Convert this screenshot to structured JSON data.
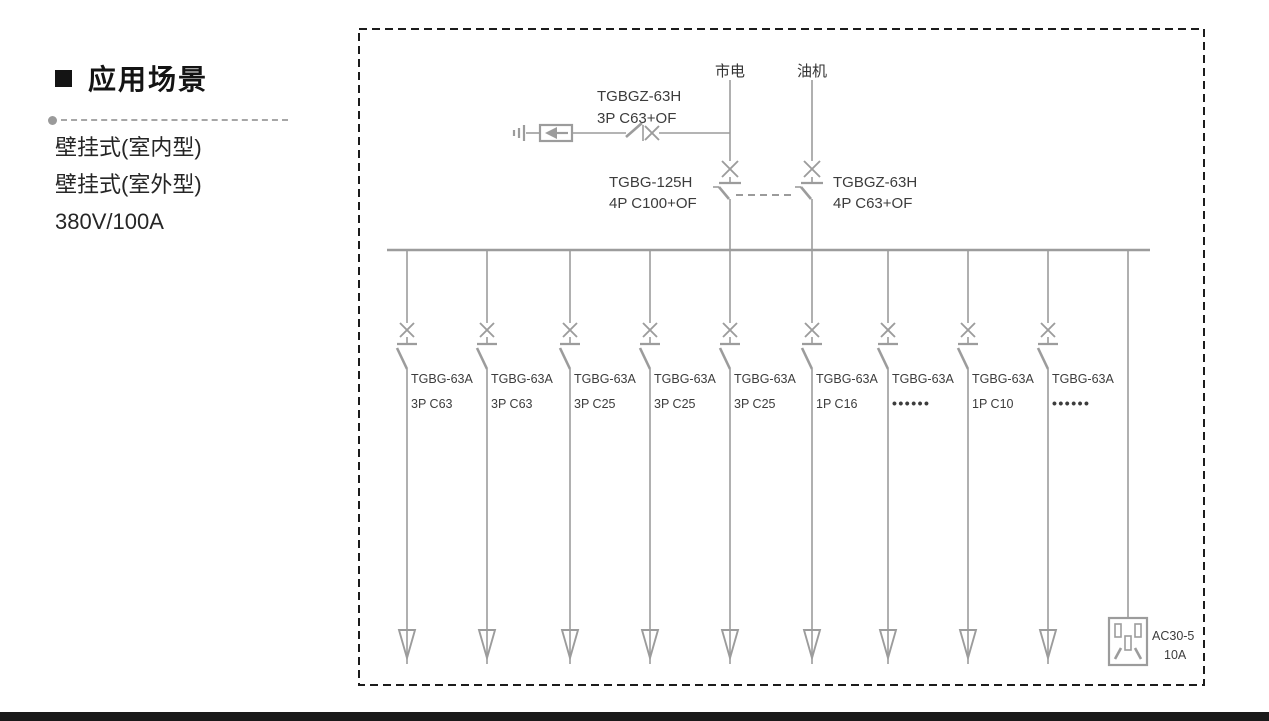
{
  "window": {
    "width": 1269,
    "height": 721
  },
  "left_panel": {
    "bullet_icon": "black-square",
    "section_title": "应用场景",
    "items": [
      "壁挂式(室内型)",
      "壁挂式(室外型)",
      "380V/100A"
    ]
  },
  "diagram": {
    "colors": {
      "line": "#9c9c9c",
      "label": "#3c3c3c",
      "border": "#1c1c1c",
      "footer_bar": "#1a1a1a"
    },
    "mains_label": "市电",
    "generator_label": "油机",
    "spd_breaker": {
      "model": "TGBGZ-63H",
      "spec": "3P C63+OF"
    },
    "mains_breaker": {
      "model": "TGBG-125H",
      "spec": "4P C100+OF"
    },
    "generator_breaker": {
      "model": "TGBGZ-63H",
      "spec": "4P C63+OF"
    },
    "branches": [
      {
        "model": "TGBG-63A",
        "spec": "3P C63"
      },
      {
        "model": "TGBG-63A",
        "spec": "3P C63"
      },
      {
        "model": "TGBG-63A",
        "spec": "3P C25"
      },
      {
        "model": "TGBG-63A",
        "spec": "3P C25"
      },
      {
        "model": "TGBG-63A",
        "spec": "3P C25"
      },
      {
        "model": "TGBG-63A",
        "spec": "1P C16"
      },
      {
        "model": "TGBG-63A",
        "spec": "••••••"
      },
      {
        "model": "TGBG-63A",
        "spec": "1P C10"
      },
      {
        "model": "TGBG-63A",
        "spec": "••••••"
      }
    ],
    "socket": {
      "model": "AC30-5",
      "rating": "10A"
    }
  }
}
